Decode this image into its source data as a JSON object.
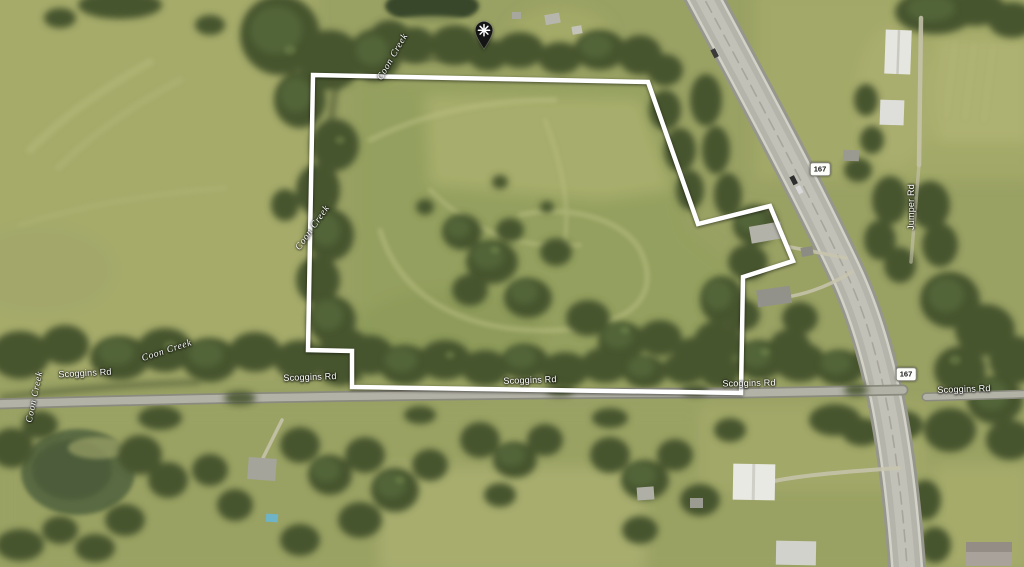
{
  "map": {
    "view": "aerial-satellite-imagery",
    "pin": {
      "tip_x": 484,
      "tip_y": 55
    },
    "parcel_boundary": {
      "stroke_color": "#ffffff",
      "points": "313,75 648,82 698,224 770,206 793,261 743,277 741,393 352,387 352,351 308,350"
    },
    "labels": [
      {
        "text": "Coon Creek",
        "x": 393,
        "y": 57,
        "rotate": -60,
        "kind": "water"
      },
      {
        "text": "Coon Creek",
        "x": 313,
        "y": 228,
        "rotate": -55,
        "kind": "water"
      },
      {
        "text": "Coon Creek",
        "x": 167,
        "y": 351,
        "rotate": -18,
        "kind": "water"
      },
      {
        "text": "Coon Creek",
        "x": 35,
        "y": 397,
        "rotate": -78,
        "kind": "water"
      },
      {
        "text": "Scoggins Rd",
        "x": 85,
        "y": 373,
        "rotate": -3,
        "kind": "road"
      },
      {
        "text": "Scoggins Rd",
        "x": 310,
        "y": 377,
        "rotate": -2,
        "kind": "road"
      },
      {
        "text": "Scoggins Rd",
        "x": 530,
        "y": 380,
        "rotate": -2,
        "kind": "road"
      },
      {
        "text": "Scoggins Rd",
        "x": 749,
        "y": 383,
        "rotate": -1,
        "kind": "road"
      },
      {
        "text": "Scoggins Rd",
        "x": 964,
        "y": 389,
        "rotate": -2,
        "kind": "road"
      },
      {
        "text": "Jumper Rd",
        "x": 911,
        "y": 207,
        "rotate": -90,
        "kind": "road"
      }
    ],
    "shields": [
      {
        "route": "167",
        "x": 820,
        "y": 169
      },
      {
        "route": "167",
        "x": 906,
        "y": 374
      }
    ],
    "colors": {
      "field": "#99a163",
      "trees": "#46552f",
      "road": "#b5b4aa",
      "water": "#3c4a2c",
      "boundary": "#ffffff",
      "label_text": "#ffffff",
      "shield_bg": "#fdfdf9",
      "shield_text": "#161616",
      "pin": "#141414"
    }
  }
}
